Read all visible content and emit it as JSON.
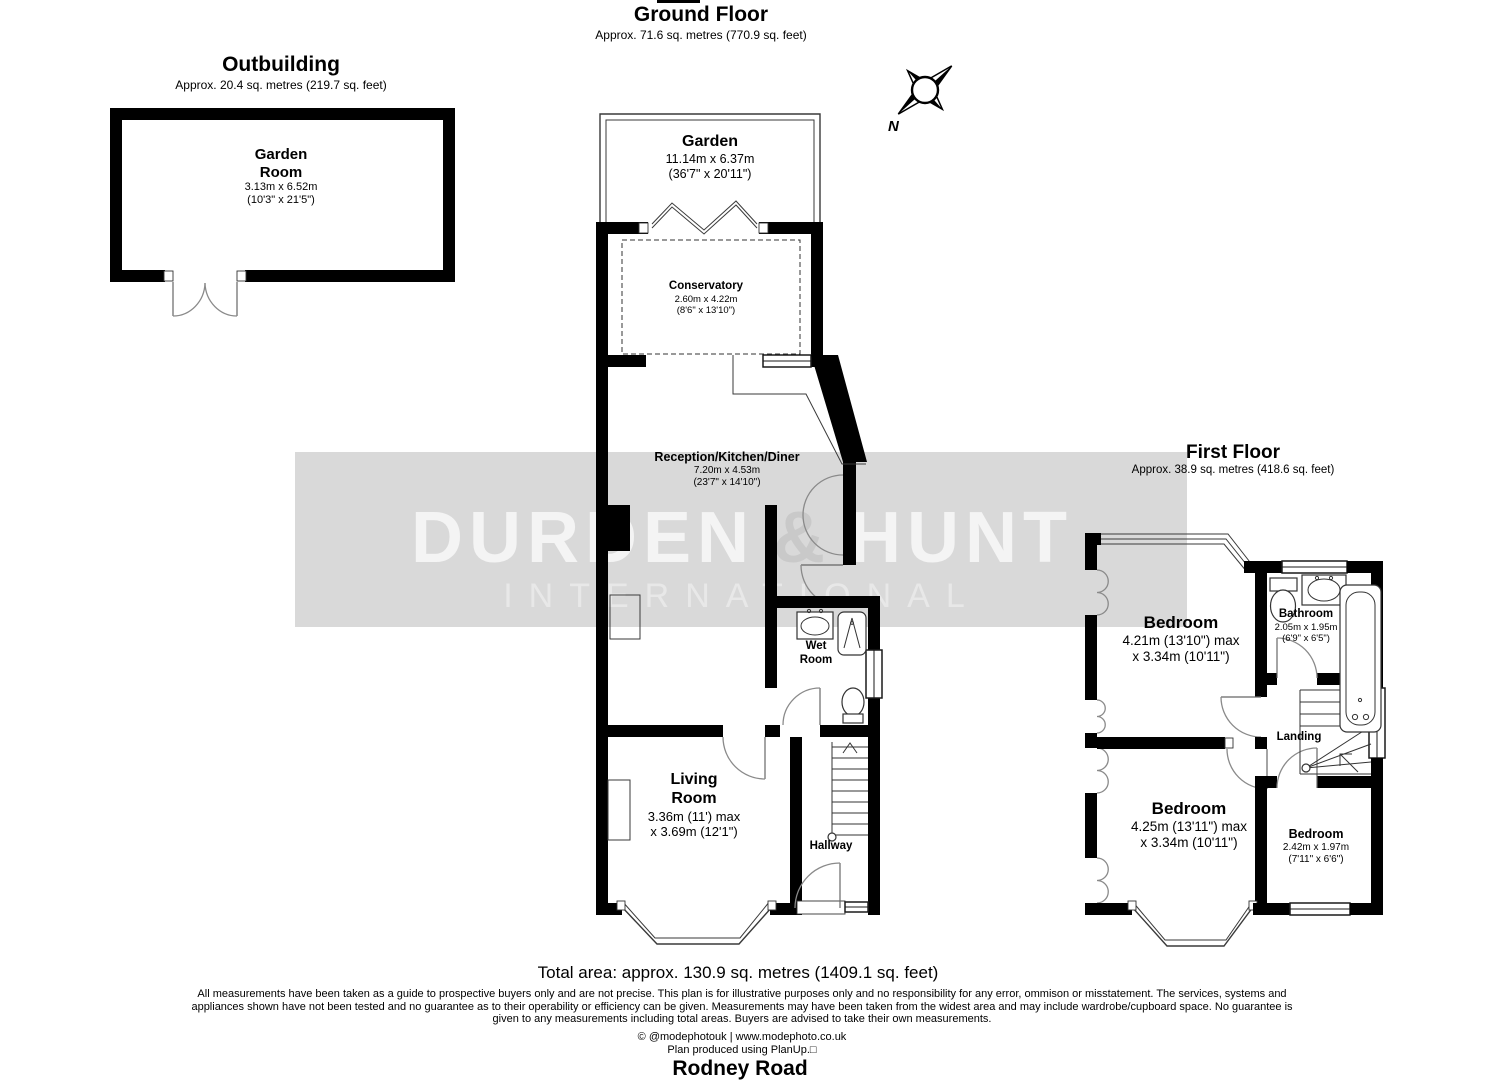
{
  "headers": {
    "ground_floor": {
      "title": "Ground Floor",
      "subtitle": "Approx. 71.6 sq. metres (770.9 sq. feet)"
    },
    "outbuilding": {
      "title": "Outbuilding",
      "subtitle": "Approx. 20.4 sq. metres (219.7 sq. feet)"
    },
    "first_floor": {
      "title": "First Floor",
      "subtitle": "Approx. 38.9 sq. metres (418.6 sq. feet)"
    }
  },
  "rooms": {
    "garden_room": {
      "name_line1": "Garden",
      "name_line2": "Room",
      "dims_line1": "3.13m x 6.52m",
      "dims_line2": "(10'3\" x 21'5\")"
    },
    "garden": {
      "name": "Garden",
      "dims_line1": "11.14m x 6.37m",
      "dims_line2": "(36'7\" x 20'11\")"
    },
    "conservatory": {
      "name": "Conservatory",
      "dims_line1": "2.60m x 4.22m",
      "dims_line2": "(8'6\" x 13'10\")"
    },
    "reception_kitchen_diner": {
      "name": "Reception/Kitchen/Diner",
      "dims_line1": "7.20m x 4.53m",
      "dims_line2": "(23'7\" x 14'10\")"
    },
    "wet_room": {
      "name_line1": "Wet",
      "name_line2": "Room"
    },
    "living_room": {
      "name_line1": "Living",
      "name_line2": "Room",
      "dims_line1": "3.36m (11') max",
      "dims_line2": "x 3.69m (12'1\")"
    },
    "hallway": {
      "name": "Hallway"
    },
    "bedroom_front": {
      "name": "Bedroom",
      "dims_line1": "4.21m (13'10\") max",
      "dims_line2": "x 3.34m (10'11\")"
    },
    "bathroom": {
      "name": "Bathroom",
      "dims_line1": "2.05m x 1.95m",
      "dims_line2": "(6'9\" x 6'5\")"
    },
    "landing": {
      "name": "Landing"
    },
    "bedroom_rear": {
      "name": "Bedroom",
      "dims_line1": "4.25m (13'11\") max",
      "dims_line2": "x 3.34m (10'11\")"
    },
    "bedroom_small": {
      "name": "Bedroom",
      "dims_line1": "2.42m x 1.97m",
      "dims_line2": "(7'11\" x 6'6\")"
    }
  },
  "watermark": {
    "word1": "DURDEN",
    "amp": "&",
    "word2": "HUNT",
    "line2": "INTERNATIONAL"
  },
  "compass": {
    "north_label": "N"
  },
  "footer": {
    "total_area": "Total area: approx. 130.9 sq. metres (1409.1 sq. feet)",
    "disclaimer_line1": "All measurements have been taken as a guide to prospective buyers only and are not precise. This plan is for illustrative purposes only and no responsibility for any error, ommison or misstatement. The services, systems and",
    "disclaimer_line2": "appliances shown have not been tested and no guarantee as to their operability or efficiency can be given. Measurements may have been taken from the widest area and may include wardrobe/cupboard space. No guarantee is",
    "disclaimer_line3": "given to any measurements including total areas. Buyers are advised to take their own measurements.",
    "credit_line1": "© @modephotouk | www.modephoto.co.uk",
    "credit_line2": "Plan produced using PlanUp.□",
    "address": "Rodney Road"
  },
  "colors": {
    "wall": "#000000",
    "thin_line": "#3a3a3a",
    "door_arc": "#8a8a8a",
    "watermark_band": "#d9d9d9",
    "watermark_word": "#f4f4f4",
    "watermark_amp": "#c9c9c9",
    "watermark_sub": "#e8e8e8"
  }
}
